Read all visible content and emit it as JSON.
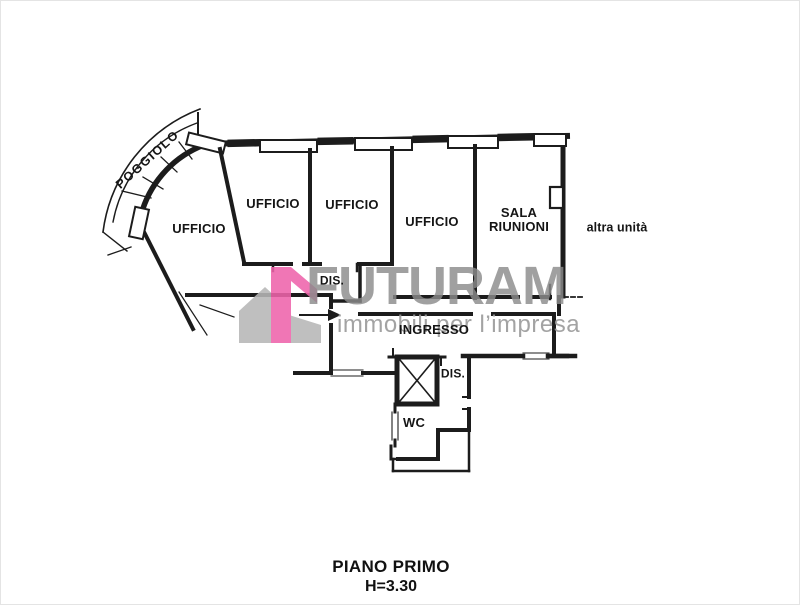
{
  "plan": {
    "rooms": [
      {
        "key": "poggiolo",
        "label": "POGGIOLO"
      },
      {
        "key": "ufficio-1",
        "label": "UFFICIO"
      },
      {
        "key": "ufficio-2",
        "label": "UFFICIO"
      },
      {
        "key": "ufficio-3",
        "label": "UFFICIO"
      },
      {
        "key": "ufficio-4",
        "label": "UFFICIO"
      },
      {
        "key": "sala-riunioni",
        "label": "SALA RIUNIONI"
      },
      {
        "key": "dis-1",
        "label": "DIS."
      },
      {
        "key": "ingresso",
        "label": "INGRESSO"
      },
      {
        "key": "dis-2",
        "label": "DIS."
      },
      {
        "key": "wc",
        "label": "WC"
      }
    ],
    "adjacent_unit_label": "altra unità",
    "floor_title": "PIANO PRIMO",
    "ceiling_height": "H=3.30"
  },
  "watermark": {
    "brand": "FUTURAM",
    "tagline": "immobili per l’impresa",
    "brand_color": "#8c8c8c",
    "tagline_color": "#9a9a9a",
    "house_gray": "#b7b7b7",
    "accent_pink": "#ef64ab"
  },
  "colors": {
    "wall": "#1c1c1c",
    "background": "#ffffff"
  }
}
